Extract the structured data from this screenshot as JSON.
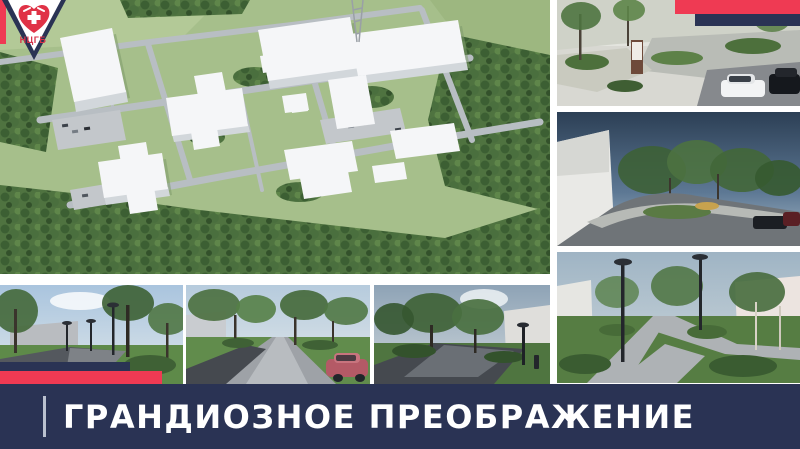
{
  "slide": {
    "title": "ГРАНДИОЗНОЕ ПРЕОБРАЖЕНИЕ"
  },
  "logo": {
    "org_abbr": "НЦГБ",
    "icon": "heart-medical-icon"
  },
  "colors": {
    "accent_red": "#ef3a53",
    "navy": "#2a3354",
    "banner_text": "#ffffff",
    "logo_text_red": "#d6334a"
  },
  "gallery": {
    "main": {
      "name": "aerial-campus-render",
      "description": "Aerial 3D render of hospital campus with white buildings, roads and surrounding forest"
    },
    "right_column": [
      {
        "name": "entrance-plaza-render",
        "description": "Paved entrance area with trees, sign pillar and parked cars"
      },
      {
        "name": "parking-lot-render",
        "description": "Landscaped parking lot under dramatic evening sky"
      },
      {
        "name": "path-junction-render",
        "description": "Paved walkway junction with lawns and lamp posts"
      }
    ],
    "bottom_row": [
      {
        "name": "park-path-render",
        "description": "Park path with lamp posts and young trees"
      },
      {
        "name": "alley-render",
        "description": "Tree-lined alley with walkway and red car"
      },
      {
        "name": "courtyard-path-render",
        "description": "Shaded courtyard path with planting and light pole"
      }
    ]
  }
}
